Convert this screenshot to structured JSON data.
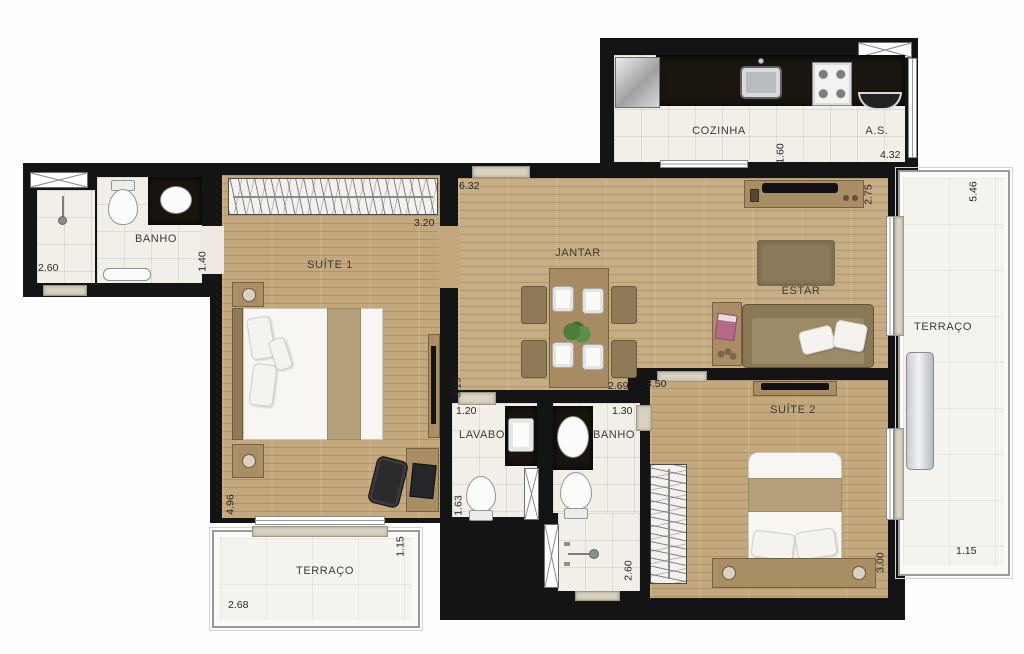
{
  "plan_title": "Planta do apartamento",
  "rooms": {
    "banho1": "BANHO",
    "suite1": "SUÍTE 1",
    "cozinha": "COZINHA",
    "area_servico": "A.S.",
    "jantar": "JANTAR",
    "estar": "ESTAR",
    "terraco_lateral": "TERRAÇO",
    "lavabo": "LAVABO",
    "banho2": "BANHO",
    "suite2": "SUÍTE 2",
    "terraco_frontal": "TERRAÇO"
  },
  "dims": {
    "banho1_w": "2.60",
    "banho1_d": "1.40",
    "closet1_w": "3.20",
    "living_w": "6.32",
    "coz_d": "1.60",
    "coz_w": "4.32",
    "estar_d": "2.75",
    "terr_lat_l": "5.46",
    "jantar_d": "3.19",
    "jantar_w": "2.69",
    "suite2_w": "3.50",
    "lavabo_w": "1.20",
    "banho2_w": "1.30",
    "suite1_d": "4.96",
    "lavabo_d": "1.63",
    "banho2_d": "2.60",
    "suite2_d": "3.00",
    "terr_front_d": "1.15",
    "terr_front_w": "2.68",
    "terr_lat_w": "1.15"
  },
  "colors": {
    "wall": "#141414",
    "wood_floor": "#c7ad84",
    "tile_floor": "#f1efe8",
    "terrace_floor": "#f5f3ed",
    "counter": "#1a150f",
    "furniture": "#a98e65",
    "threshold": "#d9d2c0"
  }
}
